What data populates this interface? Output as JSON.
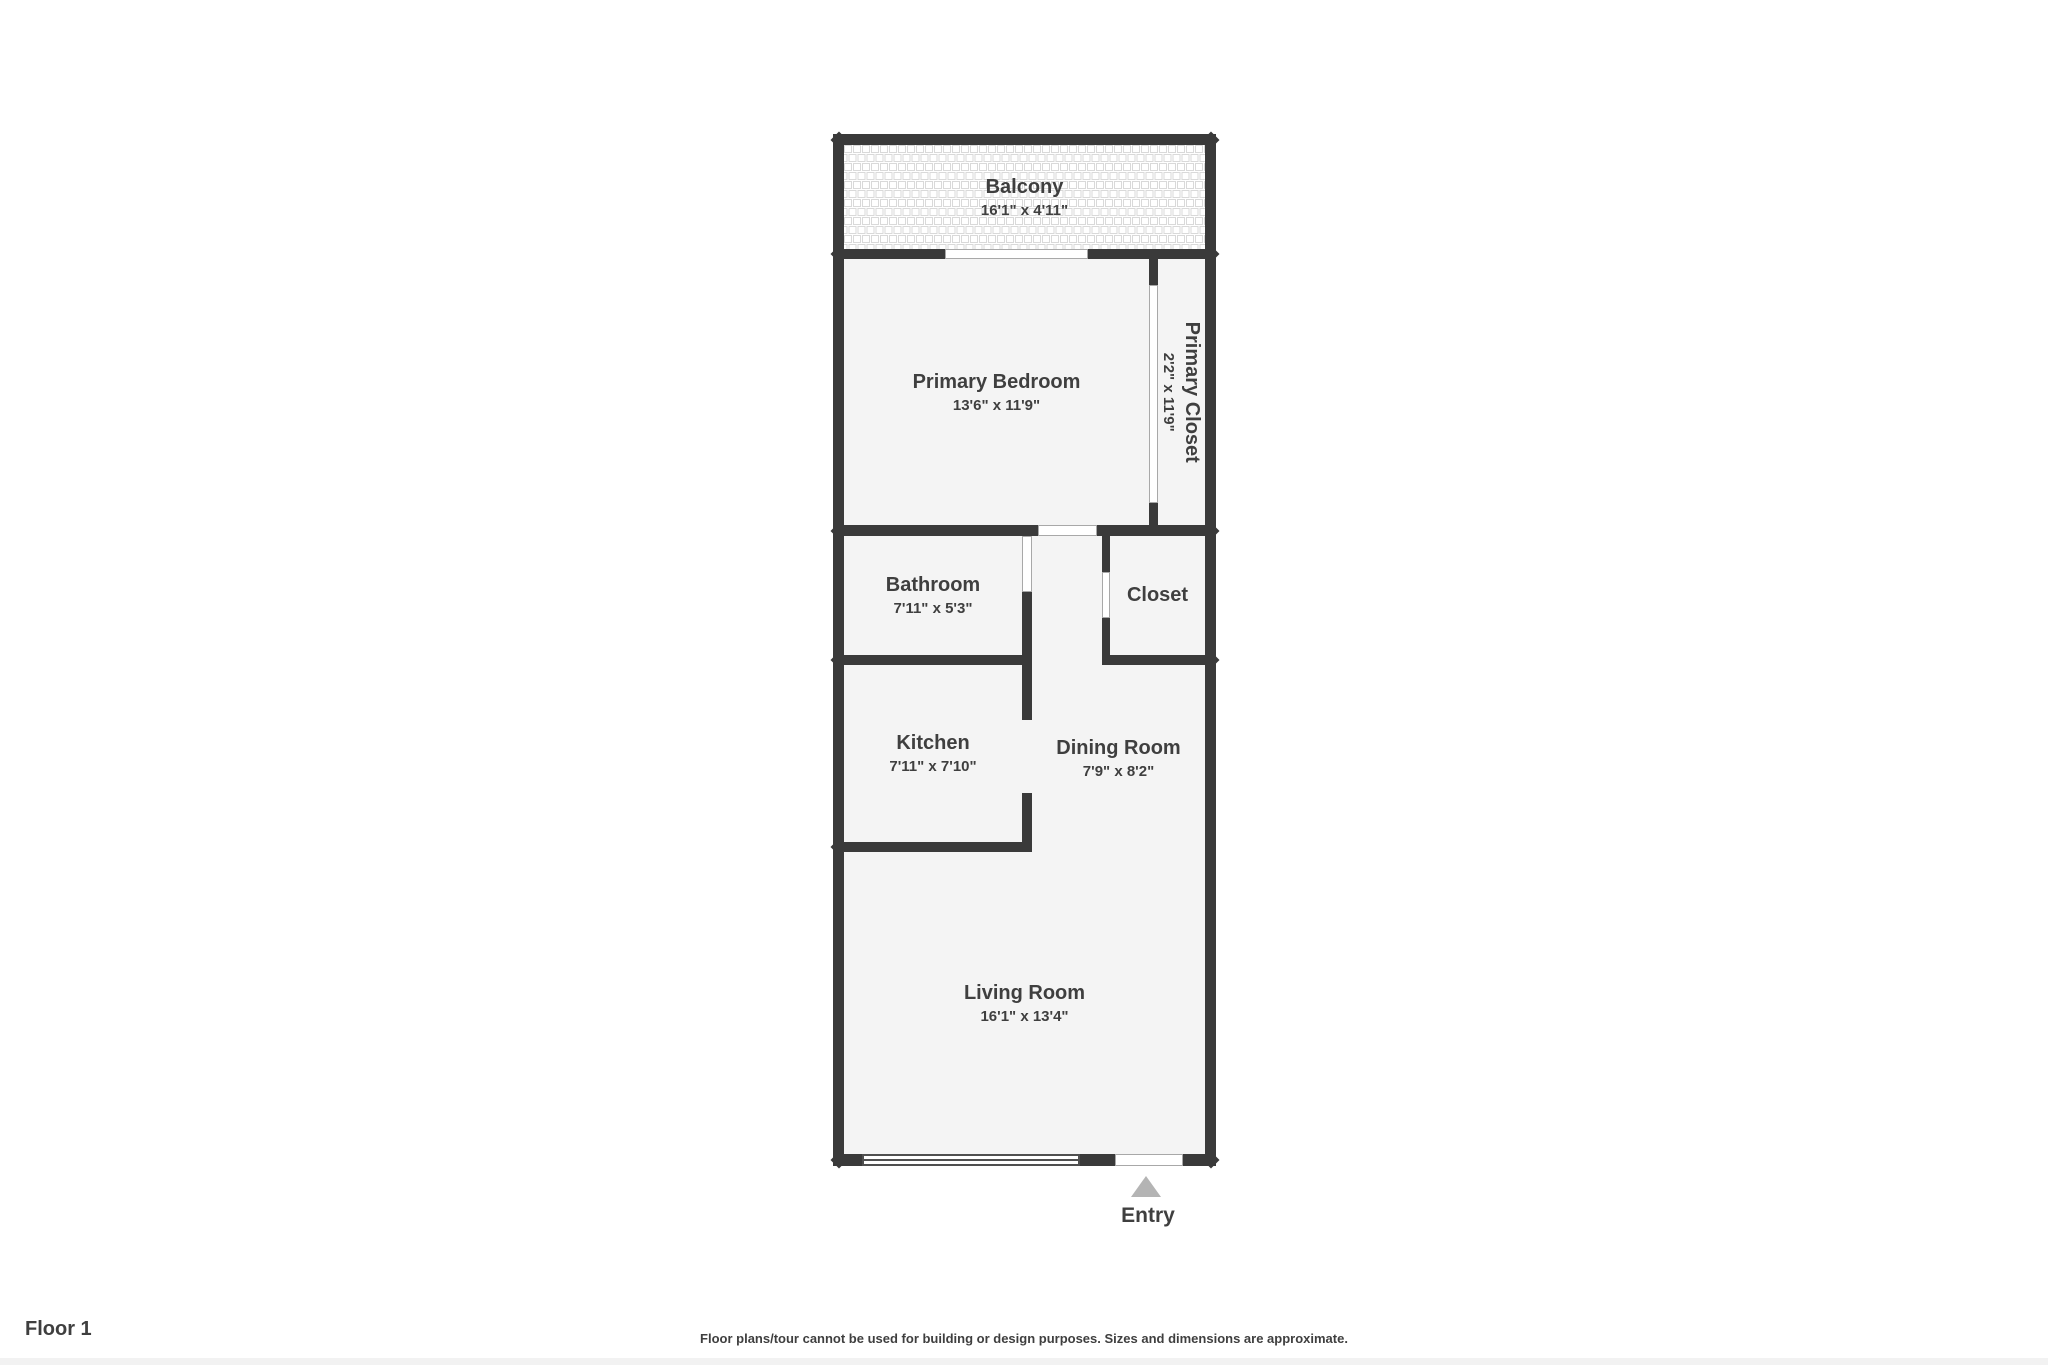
{
  "page": {
    "floor_label": "Floor 1",
    "disclaimer": "Floor plans/tour cannot be used for building or design purposes. Sizes and dimensions are approximate."
  },
  "plan": {
    "entry_label": "Entry",
    "rooms": [
      {
        "id": "balcony",
        "name": "Balcony",
        "dimensions": "16'1\" x 4'11\""
      },
      {
        "id": "primary-bedroom",
        "name": "Primary Bedroom",
        "dimensions": "13'6\" x 11'9\""
      },
      {
        "id": "primary-closet",
        "name": "Primary Closet",
        "dimensions": "2'2\" x 11'9\""
      },
      {
        "id": "bathroom",
        "name": "Bathroom",
        "dimensions": "7'11\" x 5'3\""
      },
      {
        "id": "closet",
        "name": "Closet",
        "dimensions": ""
      },
      {
        "id": "kitchen",
        "name": "Kitchen",
        "dimensions": "7'11\" x 7'10\""
      },
      {
        "id": "dining-room",
        "name": "Dining Room",
        "dimensions": "7'9\" x 8'2\""
      },
      {
        "id": "living-room",
        "name": "Living Room",
        "dimensions": "16'1\" x 13'4\""
      }
    ],
    "colors": {
      "wall": "#3a3a3a",
      "room_fill": "#f4f4f4",
      "balcony_tile_line": "#d9d9d9",
      "text": "#3f3f3f",
      "entry_arrow": "#b4b4b4",
      "door_outline": "#a8a8a8",
      "window_outline": "#4f4f4f"
    }
  }
}
